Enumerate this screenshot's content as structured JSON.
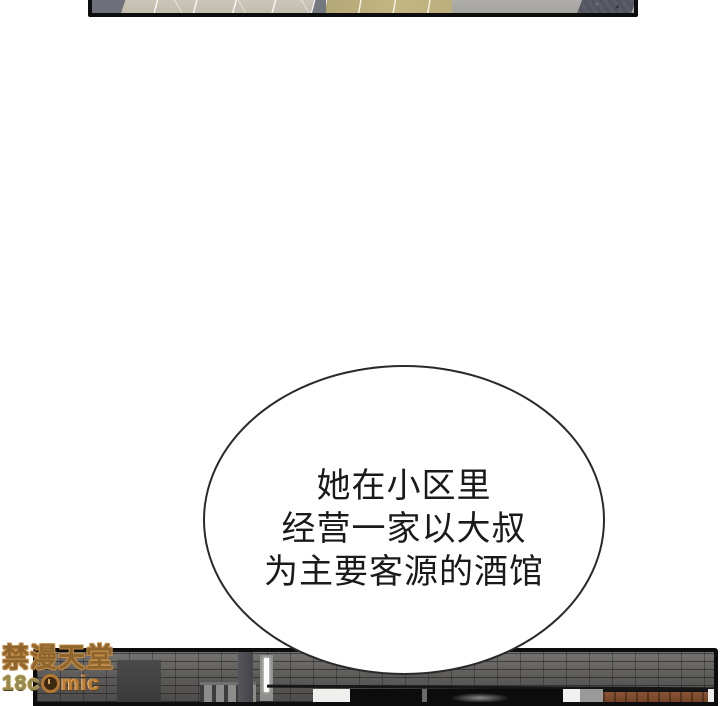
{
  "page": {
    "kind": "webtoon-comic-reader-page",
    "background": "#ffffff"
  },
  "bubble": {
    "lines": {
      "0": "她在小区里",
      "1": "经营一家以大叔",
      "2": "为主要客源的酒馆"
    },
    "outline_color": "#2a2a2a",
    "text_color": "#1a1a1a"
  },
  "watermark": {
    "title": "禁漫天堂",
    "logo_prefix": "18c",
    "logo_suffix": "mic",
    "watch_icon": "watch-icon",
    "orange": "#c08b45"
  },
  "panels": {
    "top": {
      "description": "cropped panel strip: perspective floor tiles (beige/khaki) with slate shapes",
      "border_color": "#0d0d0d"
    },
    "bottom": {
      "description": "cropped panel: dark brick wall street, railing, light tube, shopfront with wooden sign",
      "border_color": "#0d0d0d",
      "sign_brown": "#7b4a2c",
      "brick_gray": "#5a5a5a"
    }
  }
}
